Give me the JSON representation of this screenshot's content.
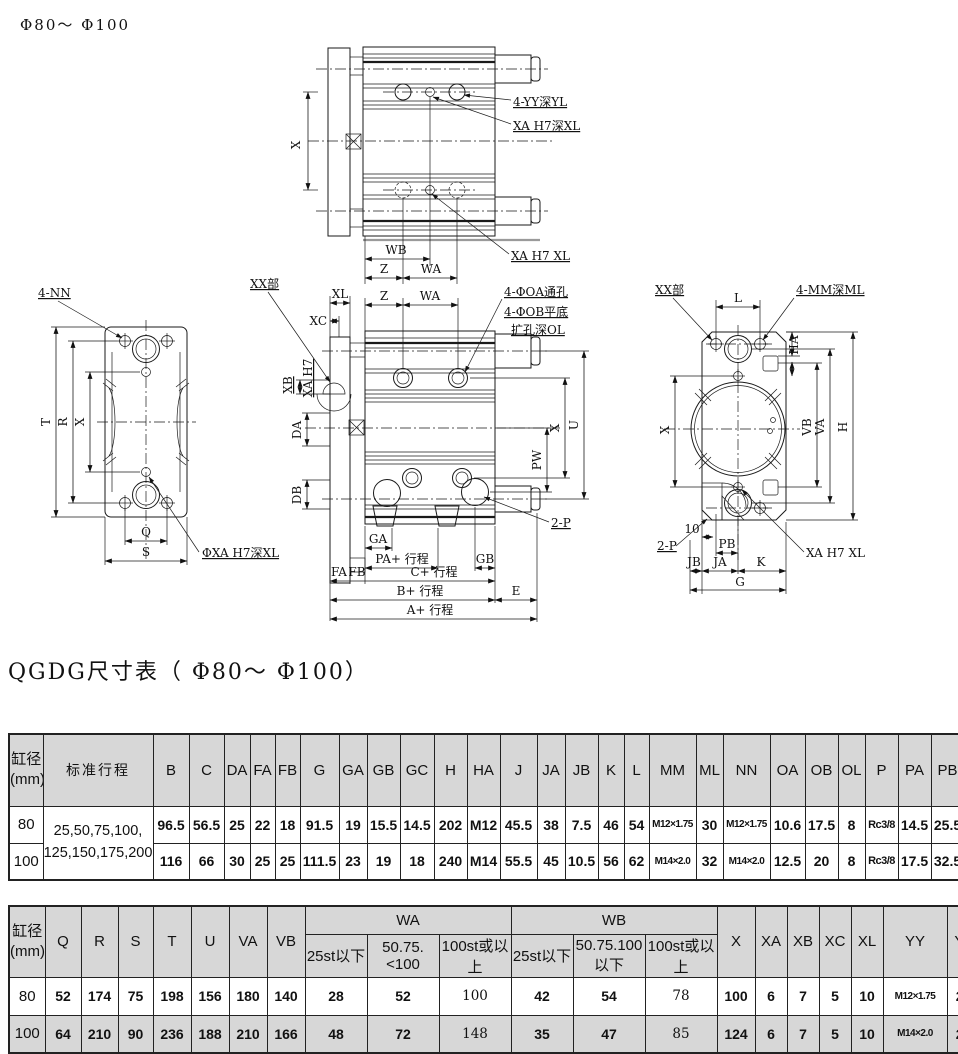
{
  "page": {
    "top_label": "Φ80～ Φ100",
    "section_title": "QGDG尺寸表（ Φ80～ Φ100）"
  },
  "drawings": {
    "top": {
      "dim_x": "X",
      "dim_wb": "WB",
      "dim_z": "Z",
      "dim_wa": "WA",
      "callout_yy": "4-YY深YL",
      "callout_xa_deep": "XA H7深XL",
      "callout_xa": "XA  H7  XL"
    },
    "left": {
      "callout_nn": "4-NN",
      "callout_xa": "ΦXA H7深XL",
      "dim_t": "T",
      "dim_r": "R",
      "dim_x": "X",
      "dim_q": "Q",
      "dim_s": "S"
    },
    "front": {
      "callout_xx": "XX部",
      "callout_oa": "4-ΦOA通孔",
      "callout_ob": "4-ΦOB平底",
      "callout_ol": "扩孔深OL",
      "callout_2p": "2-P",
      "dim_xl": "XL",
      "dim_xc": "XC",
      "dim_z": "Z",
      "dim_wa": "WA",
      "dim_xb": "XB",
      "dim_xa_h7": "XA H7",
      "dim_da": "DA",
      "dim_db": "DB",
      "dim_pw": "PW",
      "dim_x": "X",
      "dim_u": "U",
      "dim_ga": "GA",
      "dim_pa": "PA+ 行程",
      "dim_gb": "GB",
      "dim_fa": "FA",
      "dim_fb": "FB",
      "dim_c": "C+ 行程",
      "dim_b": "B+ 行程",
      "dim_e": "E",
      "dim_a": "A+ 行程"
    },
    "right": {
      "callout_xx": "XX部",
      "callout_mm": "4-MM深ML",
      "callout_2p": "2-P",
      "callout_xa": "XA  H7  XL",
      "dim_l": "L",
      "dim_ha": "HA",
      "dim_x": "X",
      "dim_vb": "VB",
      "dim_va": "VA",
      "dim_h": "H",
      "dim_10": "10",
      "dim_pb": "PB",
      "dim_jb": "JB",
      "dim_ja": "JA",
      "dim_k": "K",
      "dim_g": "G"
    }
  },
  "table1": {
    "bore_header": [
      "缸径",
      "(mm)"
    ],
    "stroke_header": "标准行程",
    "headers": [
      "B",
      "C",
      "DA",
      "FA",
      "FB",
      "G",
      "GA",
      "GB",
      "GC",
      "H",
      "HA",
      "J",
      "JA",
      "JB",
      "K",
      "L",
      "MM",
      "ML",
      "NN",
      "OA",
      "OB",
      "OL",
      "P",
      "PA",
      "PB",
      "PW"
    ],
    "stroke_value": [
      "25,50,75,100,",
      "125,150,175,200"
    ],
    "rows": [
      {
        "bore": "80",
        "values": [
          "96.5",
          "56.5",
          "25",
          "22",
          "18",
          "91.5",
          "19",
          "15.5",
          "14.5",
          "202",
          "M12",
          "45.5",
          "38",
          "7.5",
          "46",
          "54",
          "M12×1.75",
          "30",
          "M12×1.75",
          "10.6",
          "17.5",
          "8",
          "Rc3/8",
          "14.5",
          "25.5",
          "74"
        ]
      },
      {
        "bore": "100",
        "values": [
          "116",
          "66",
          "30",
          "25",
          "25",
          "111.5",
          "23",
          "19",
          "18",
          "240",
          "M14",
          "55.5",
          "45",
          "10.5",
          "56",
          "62",
          "M14×2.0",
          "32",
          "M14×2.0",
          "12.5",
          "20",
          "8",
          "Rc3/8",
          "17.5",
          "32.5",
          "89"
        ]
      }
    ]
  },
  "table2": {
    "bore_header": [
      "缸径",
      "(mm)"
    ],
    "left_headers": [
      "Q",
      "R",
      "S",
      "T",
      "U",
      "VA",
      "VB"
    ],
    "wa_group": {
      "label": "WA",
      "subs": [
        "25st以下",
        "50.75.<100",
        "100st或以上"
      ]
    },
    "wb_group": {
      "label": "WB",
      "subs": [
        "25st以下",
        "50.75.100以下",
        "100st或以上"
      ]
    },
    "right_headers": [
      "X",
      "XA",
      "XB",
      "XC",
      "XL",
      "YY",
      "YL",
      "Z"
    ],
    "rows": [
      {
        "bore": "80",
        "values": [
          "52",
          "174",
          "75",
          "198",
          "156",
          "180",
          "140",
          "28",
          "52",
          "100",
          "42",
          "54",
          "78",
          "100",
          "6",
          "7",
          "5",
          "10",
          "M12×1.75",
          "24",
          "28"
        ]
      },
      {
        "bore": "100",
        "values": [
          "64",
          "210",
          "90",
          "236",
          "188",
          "210",
          "166",
          "48",
          "72",
          "148",
          "35",
          "47",
          "85",
          "124",
          "6",
          "7",
          "5",
          "10",
          "M14×2.0",
          "28",
          "11"
        ]
      }
    ]
  }
}
